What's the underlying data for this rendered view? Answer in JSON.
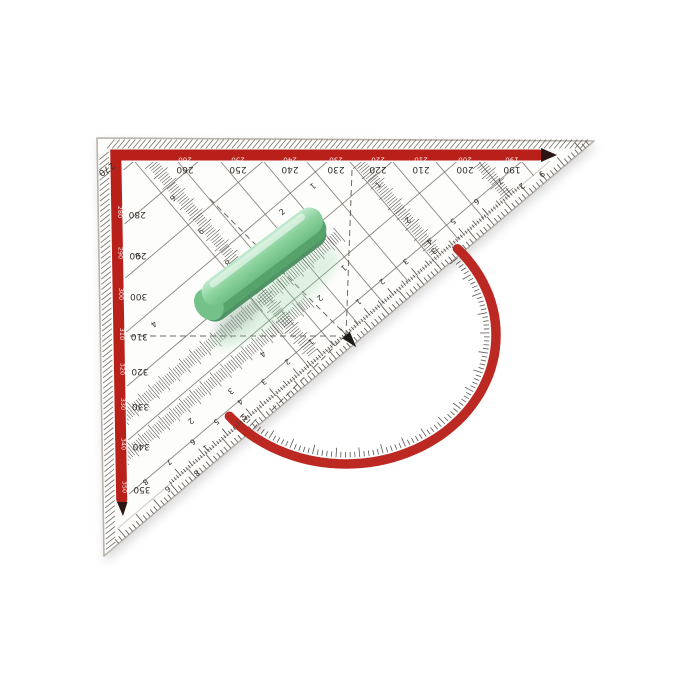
{
  "image": {
    "type": "product-photo",
    "subject": "transparent geometry set square (set square protractor ruler) with red markings and green grip handle",
    "background": "white"
  },
  "colors": {
    "red": "#b9201a",
    "red_deep": "#8e120e",
    "arrow_black": "#2b1512",
    "ink": "#332e29",
    "grid": "#6e6760",
    "hatch": "#55504a",
    "edge": "#b9b3ac",
    "green_main": "#7fcc92",
    "green_light": "#c2ead0",
    "green_dark": "#56a36c",
    "green_deep": "#498e5e",
    "body": "#fdfdfc"
  },
  "protractor": {
    "top_labels": [
      "270",
      "260",
      "250",
      "240",
      "230",
      "220",
      "210",
      "200",
      "190"
    ],
    "left_labels": [
      "280",
      "290",
      "300",
      "310",
      "320",
      "330",
      "340",
      "350"
    ]
  },
  "hypotenuse_scale": {
    "right": [
      "1",
      "2",
      "3",
      "4",
      "5",
      "6",
      "7"
    ],
    "left": [
      "1",
      "2",
      "3",
      "4",
      "5",
      "6",
      "7",
      "8"
    ],
    "unit": "cm"
  },
  "grid_digits": [
    {
      "v": "6",
      "x": 171,
      "y": 196,
      "r": 140
    },
    {
      "v": "9",
      "x": 199,
      "y": 229,
      "r": 140
    },
    {
      "v": "8",
      "x": 226,
      "y": 261,
      "r": 140
    },
    {
      "v": "7",
      "x": 253,
      "y": 293,
      "r": -40
    },
    {
      "v": "1",
      "x": 311,
      "y": 184,
      "r": 140
    },
    {
      "v": "2",
      "x": 284,
      "y": 214,
      "r": -40
    },
    {
      "v": "1",
      "x": 380,
      "y": 187,
      "r": -40
    },
    {
      "v": "2",
      "x": 406,
      "y": 218,
      "r": 140
    },
    {
      "v": "3",
      "x": 432,
      "y": 249,
      "r": 140
    },
    {
      "v": "9",
      "x": 540,
      "y": 172,
      "r": 140
    },
    {
      "v": "2",
      "x": 520,
      "y": 184,
      "r": 140
    },
    {
      "v": "3",
      "x": 140,
      "y": 258,
      "r": -40
    },
    {
      "v": "4",
      "x": 152,
      "y": 322,
      "r": 140
    },
    {
      "v": "4",
      "x": 261,
      "y": 352,
      "r": 140
    },
    {
      "v": "3",
      "x": 229,
      "y": 389,
      "r": 140
    },
    {
      "v": "5",
      "x": 246,
      "y": 419,
      "r": -40
    },
    {
      "v": "2",
      "x": 189,
      "y": 419,
      "r": 140
    },
    {
      "v": "1",
      "x": 204,
      "y": 446,
      "r": 140
    },
    {
      "v": "8",
      "x": 195,
      "y": 471,
      "r": 140
    },
    {
      "v": "6",
      "x": 166,
      "y": 487,
      "r": 140
    },
    {
      "v": "2",
      "x": 318,
      "y": 296,
      "r": 140
    },
    {
      "v": "1",
      "x": 342,
      "y": 266,
      "r": 140
    }
  ]
}
